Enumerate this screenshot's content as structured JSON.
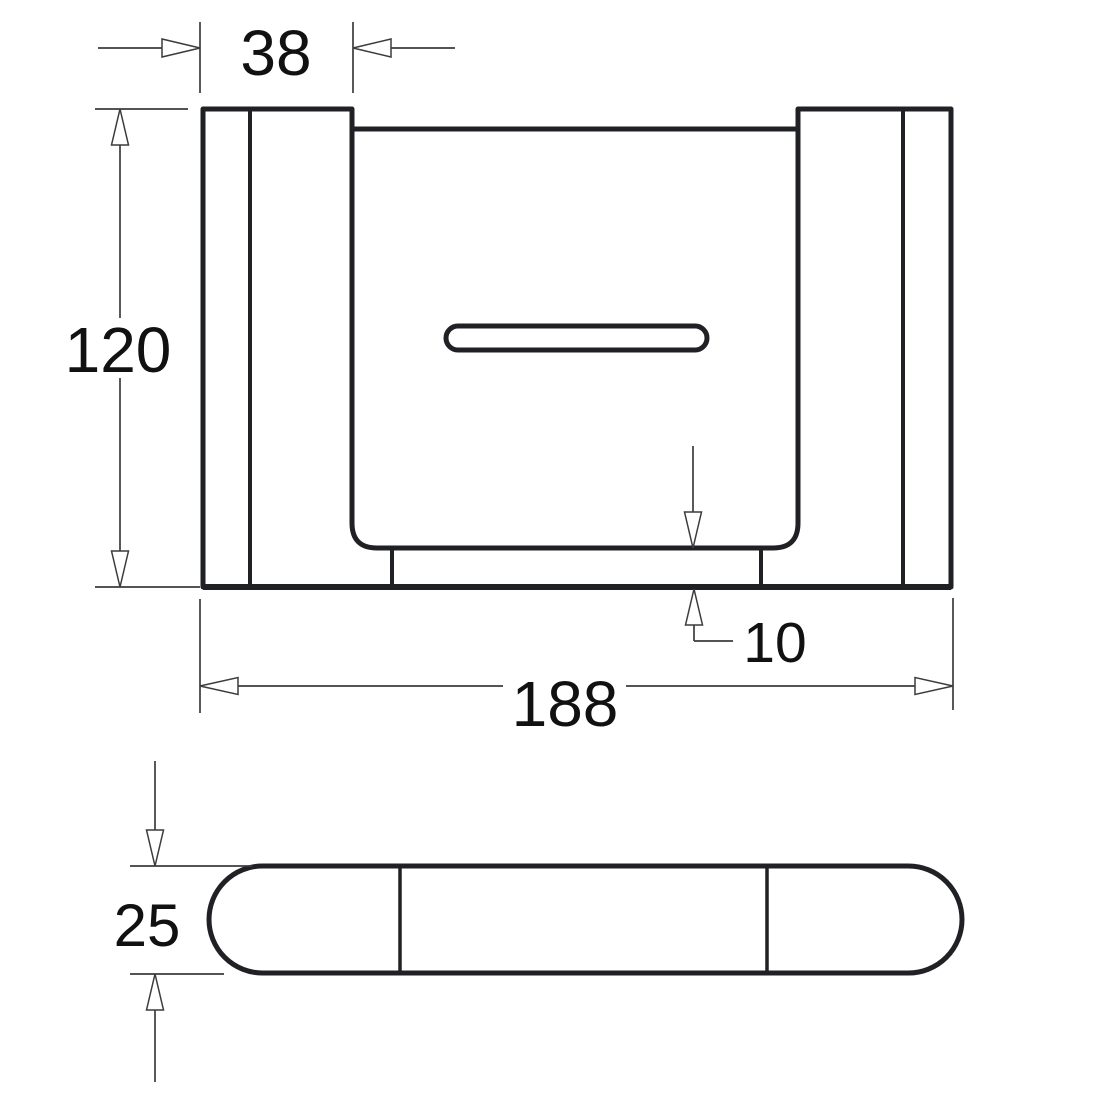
{
  "drawing": {
    "type": "technical-dimension-drawing",
    "colors": {
      "background": "#ffffff",
      "outline": "#202124",
      "dimension_lines": "#3c3c3c",
      "text": "#111111"
    },
    "dims": {
      "bracket_width": {
        "value": "38"
      },
      "height": {
        "value": "120"
      },
      "overall_width": {
        "value": "188"
      },
      "shelf_thickness": {
        "value": "10"
      },
      "depth": {
        "value": "25"
      }
    }
  }
}
